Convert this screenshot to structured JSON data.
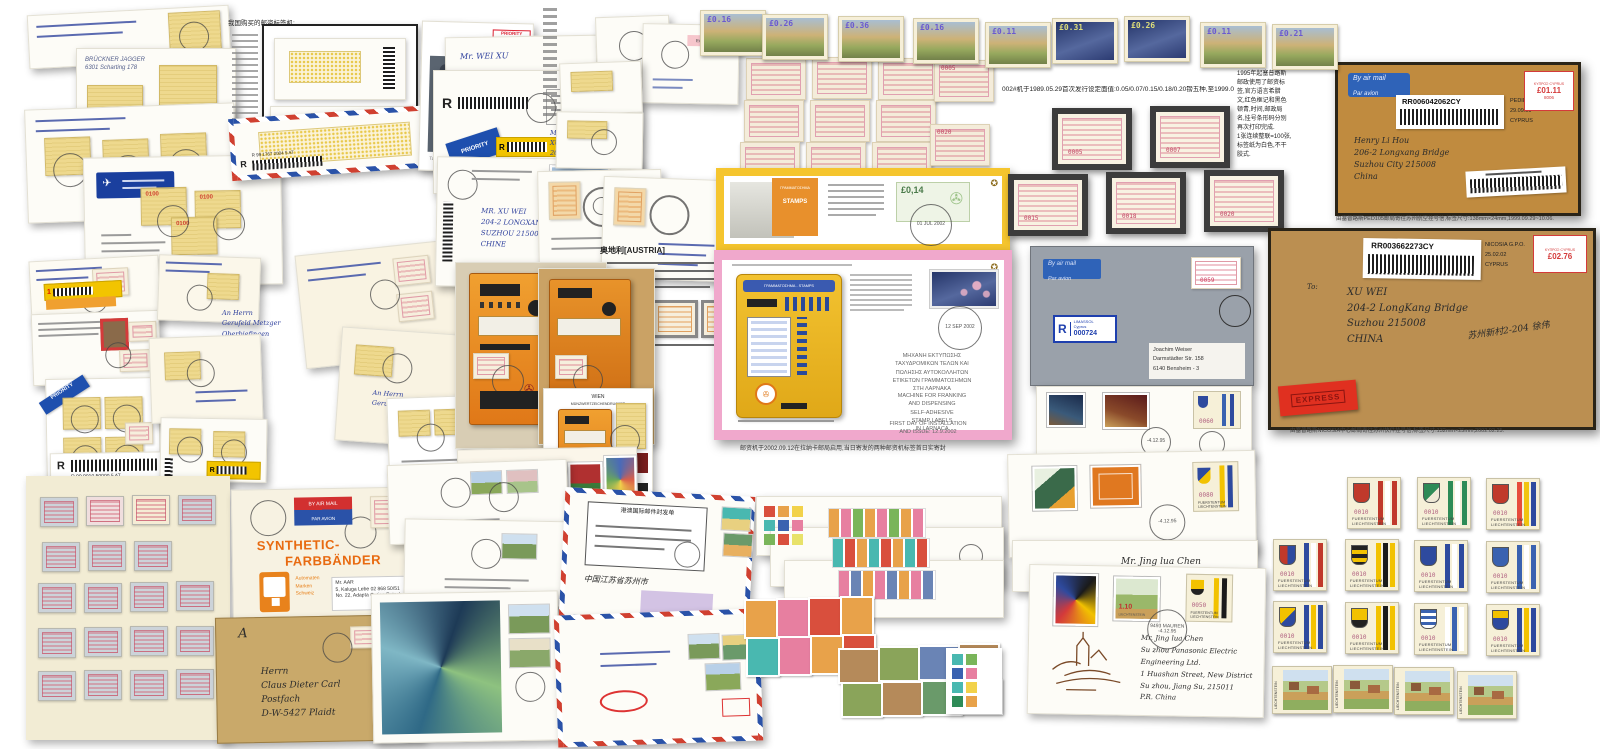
{
  "top_row": {
    "stamps": [
      {
        "x": 700,
        "y": 10,
        "v": "£0.16",
        "bg": "linear-gradient(180deg,#a9bed2 0%,#cdb277 45%,#97a95e 72%,#72814a 100%)",
        "vc": "#6a5ad0"
      },
      {
        "x": 762,
        "y": 14,
        "v": "£0.26",
        "bg": "linear-gradient(180deg,#a9bed2 0%,#cdb277 45%,#97a95e 72%,#72814a 100%)",
        "vc": "#6a5ad0"
      },
      {
        "x": 838,
        "y": 16,
        "v": "£0.36",
        "bg": "linear-gradient(180deg,#a9bed2 0%,#cdb277 45%,#97a95e 72%,#72814a 100%)",
        "vc": "#6a5ad0"
      },
      {
        "x": 913,
        "y": 18,
        "v": "£0.16",
        "bg": "linear-gradient(180deg,#a9bed2 0%,#cdb277 45%,#97a95e 72%,#72814a 100%)",
        "vc": "#6a5ad0"
      },
      {
        "x": 985,
        "y": 22,
        "v": "£0.11",
        "bg": "linear-gradient(180deg,#a9bed2 0%,#cdb277 45%,#97a95e 72%,#72814a 100%)",
        "vc": "#6a5ad0"
      },
      {
        "x": 1052,
        "y": 18,
        "v": "£0.31",
        "bg": "linear-gradient(160deg,#243468,#55689e 55%,#2c3b72)",
        "vc": "#dede7a"
      },
      {
        "x": 1124,
        "y": 16,
        "v": "£0.26",
        "bg": "linear-gradient(160deg,#243468,#55689e 55%,#2c3b72)",
        "vc": "#dede7a"
      },
      {
        "x": 1200,
        "y": 22,
        "v": "£0.11",
        "bg": "linear-gradient(180deg,#a9bed2 0%,#cdb277 45%,#97a95e 72%,#72814a 100%)",
        "vc": "#6a5ad0"
      },
      {
        "x": 1272,
        "y": 24,
        "v": "£0.21",
        "bg": "linear-gradient(180deg,#a9bed2 0%,#cdb277 45%,#97a95e 72%,#72814a 100%)",
        "vc": "#6a5ad0"
      }
    ]
  },
  "cyprus": {
    "caption": "002#机于1989.05.29首次发行设定面值:0.05/0.07/0.15/0.18/0.20镑五种,至1999.0",
    "loose": [
      {
        "x": 746,
        "y": 58,
        "v": ""
      },
      {
        "x": 812,
        "y": 57,
        "v": ""
      },
      {
        "x": 878,
        "y": 58,
        "v": ""
      },
      {
        "x": 744,
        "y": 100,
        "v": ""
      },
      {
        "x": 810,
        "y": 100,
        "v": ""
      },
      {
        "x": 876,
        "y": 100,
        "v": ""
      },
      {
        "x": 740,
        "y": 142,
        "v": ""
      },
      {
        "x": 806,
        "y": 142,
        "v": ""
      },
      {
        "x": 872,
        "y": 142,
        "v": ""
      },
      {
        "x": 934,
        "y": 60,
        "v": "0005"
      },
      {
        "x": 930,
        "y": 124,
        "v": "0020"
      }
    ],
    "framed": [
      {
        "x": 1052,
        "y": 108,
        "v": "0005"
      },
      {
        "x": 1150,
        "y": 106,
        "v": "0007"
      },
      {
        "x": 1008,
        "y": 174,
        "v": "0015"
      },
      {
        "x": 1106,
        "y": 172,
        "v": "0018"
      },
      {
        "x": 1204,
        "y": 170,
        "v": "0020"
      }
    ],
    "notes": [
      "1995年起塞普路斯",
      "邮政使用了邮资标",
      "签,官方语言希腊",
      "文,红色框记和黑色",
      "顿青,时间,邮政局",
      "名,挂号条形码分别",
      "再次打印完成.",
      "1张连续整联=100张,",
      "标签纸为白色,不干",
      "胶式."
    ]
  },
  "env1": {
    "air1": "By air mail",
    "air2": "Par avion",
    "code": "RR006042062CY",
    "po": "PEDIEOS P.O.",
    "date": "29.09.99",
    "country": "CYPRUS",
    "meter": "£01.11",
    "meter_no": "8006",
    "meter_hdr": "ΚΥΠΡΟΣ·CYPRUS",
    "addr": [
      "Henry Li Hou",
      "206-2 Longxang Bridge",
      "Suzhou City 215008",
      "China"
    ],
    "caption": "由塞普路斯PED105邮局寄往苏州航空挂号信,标签尺寸:138mm×24mm,1999.09.29~10.06."
  },
  "env2": {
    "code": "RR003662273CY",
    "po": "NICOSIA G.P.O.",
    "date": "25.02.02",
    "country": "CYPRUS",
    "meter": "£02.76",
    "meter_hdr": "ΚΥΠΡΟΣ·CYPRUS",
    "to": "To:",
    "addr": [
      "XU WEI",
      "204-2 LongKang Bridge",
      "Suzhou 215008",
      "CHINA"
    ],
    "note_cn": "苏州新村2-204 徐伟",
    "express": "EXPRESS",
    "caption": "由塞普路斯NICOSIA中心邮局寄往苏州快件挂号信,标签尺寸:132mm×25mm,2002.02.25."
  },
  "gray_cover": {
    "air1": "By air mail",
    "air2": "Par avion",
    "r": "R",
    "r_city": "LIMASSOL",
    "r_sub": "Cyprus",
    "r_no": "000724",
    "atm": "0059",
    "addr": [
      "Joachim Weiser",
      "Darmstädter Str. 158",
      "6140 Bensheim - 3"
    ]
  },
  "brochures": {
    "machine_title": "ΓΡΑΜΜΑΤΟΣΗΜΑ - STAMPS",
    "poster1": "ΓΡΑΜΜΑΤΟΣΗΜΑ",
    "poster2": "STAMPS",
    "stamp1_value": "£0,14",
    "pm1_date": "01 JUL 2002",
    "pm2_date": "12 SEP 2002",
    "greek": [
      "ΜΗΧΑΝΗ ΕΚΤΥΠΩΣΗΣ",
      "ΤΑΧΥΔΡΟΜΙΚΩΝ ΤΕΛΩΝ ΚΑΙ",
      "ΠΩΛΗΣΗΣ ΑΥΤΟΚΟΛΛΗΤΩΝ",
      "ΕΤΙΚΕΤΩΝ ΓΡΑΜΜΑΤΟΣΗΜΩΝ",
      "ΣΤΗ ΛΑΡΝΑΚΑ"
    ],
    "english": [
      "MACHINE FOR FRANKING",
      "AND DISPENSING",
      "SELF-ADHESIVE",
      "STAMP LABELS",
      "IN LARNACA"
    ],
    "first_day": [
      "FIRST DAY OF INSTALLATION",
      "AND ISSUE: 12.9.2002"
    ],
    "caption_cn": "邮资机于2002.09.12在拉纳卡邮局启用,当日寄发的两种邮资机标签首日实寄封"
  },
  "austria": {
    "heading": "奥地利[AUSTRIA]",
    "wien1": "WIEN",
    "wien2": "MÜNZWERTZEICHENDRUCKER",
    "fdc_hand": [
      "204-2 Long Kang Bridge",
      "Su Zhou 215008"
    ]
  },
  "liech": {
    "value": "0010",
    "c1": "FUERSTENTUM",
    "c2": "LIECHTENSTEIN",
    "grid": [
      {
        "x": 1347,
        "y": 477,
        "shield": "#c0392b",
        "s1": "#c0392b",
        "s2": "#ffffff",
        "s3": "#c0392b"
      },
      {
        "x": 1417,
        "y": 477,
        "shield": "linear-gradient(135deg,#2e8b57 55%,#eee8d5 55%)",
        "s1": "#2e8b57",
        "s2": "#ffffff",
        "s3": "#2e8b57"
      },
      {
        "x": 1486,
        "y": 478,
        "shield": "#c0392b",
        "s1": "#e74c3c",
        "s2": "#f1c40f",
        "s3": "#2e4a9e"
      },
      {
        "x": 1273,
        "y": 539,
        "shield": "linear-gradient(90deg,#c0392b 50%,#2e4a9e 50%)",
        "s1": "#2e4a9e",
        "s2": "#ffffff",
        "s3": "#c0392b"
      },
      {
        "x": 1345,
        "y": 539,
        "shield": "repeating-linear-gradient(180deg,#222 0 4px,#f2c200 4px 8px)",
        "s1": "#f2c200",
        "s2": "#1a1a1a",
        "s3": "#f2c200"
      },
      {
        "x": 1414,
        "y": 540,
        "shield": "#2e4a9e",
        "s1": "#2e4a9e",
        "s2": "#ffffff",
        "s3": "#2e4a9e"
      },
      {
        "x": 1486,
        "y": 541,
        "shield": "#3a62b0",
        "s1": "#3a62b0",
        "s2": "#ffffff",
        "s3": "#3a62b0"
      },
      {
        "x": 1273,
        "y": 601,
        "shield": "linear-gradient(135deg,#f2c200 50%,#2e4a9e 50%)",
        "s1": "#2e4a9e",
        "s2": "#f2c200",
        "s3": "#2e4a9e"
      },
      {
        "x": 1345,
        "y": 602,
        "shield": "linear-gradient(180deg,#f2c200 60%,#222 60%)",
        "s1": "#f2c200",
        "s2": "#1a1a1a",
        "s3": "#f2c200"
      },
      {
        "x": 1414,
        "y": 603,
        "shield": "repeating-linear-gradient(180deg,#3a62b0 0 3px,#ffffff 3px 6px)",
        "s1": "#ffffff",
        "s2": "#3a62b0",
        "s3": "#ffffff"
      },
      {
        "x": 1486,
        "y": 604,
        "shield": "linear-gradient(180deg,#f2c200 40%,#2e4a9e 40%)",
        "s1": "#2e4a9e",
        "s2": "#f2c200",
        "s3": "#2e4a9e"
      }
    ],
    "villages": [
      {
        "x": 1272,
        "y": 666
      },
      {
        "x": 1333,
        "y": 665
      },
      {
        "x": 1394,
        "y": 667
      },
      {
        "x": 1457,
        "y": 671
      }
    ],
    "atm60": "0060",
    "atm80": "0080",
    "atm50": "0050",
    "green_value": "1.10",
    "green_country": "LIECHTENSTEIN",
    "pm_town": "9493 MAUREN",
    "pm_date": "-4.12.95",
    "fdc3_name": "Mr. Jing lua Chen",
    "owl_addr": [
      "Mr. Jing lua Chen",
      "Su zhou Panasonic Electric Engineering Ltd.",
      "1 Huashan Street, New District",
      "Su zhou, Jiang Su, 215011",
      "P.R. China"
    ]
  },
  "registered": {
    "r": "R",
    "priority1": "PRIORITY",
    "priority2": "PRIORITAIRE",
    "weixu": "Mr. WEI XU",
    "d1_hand": [
      "Mr.",
      "XU WEI",
      "206-2 Longxang Brd."
    ],
    "d2_addr": [
      "MR. XU WEI",
      "204-2 LONGXANG BRIDGE",
      "SUZHOU 215008",
      "CHINE"
    ],
    "code_b": "R 99 1767 2004 5 AT",
    "code_s7": "R 99 9010 50000 5 AT"
  },
  "synthetic": {
    "airmail": "BY AIR MAIL",
    "parvion": "PAR AVION",
    "t1": "SYNTHETIC-",
    "t2": "FARBBÄNDER",
    "sub": [
      "Automaten",
      "Marken",
      "Schweiz"
    ],
    "addr": [
      "Mr. AAR",
      "5, Kaluga Lebe 02 868 50/51",
      "No. 22, Adapta Outing Patnab"
    ]
  },
  "kraft_env": {
    "a": "A",
    "addr": [
      "Herrn",
      "Claus Dieter Carl",
      "Postfach",
      "D-W-5427 Plaidt"
    ]
  },
  "misc": {
    "cn_heading": "我国购买的邮资标签机:",
    "postbus": "Tag der Briefmarke",
    "eulach": "Eulach - Natur",
    "brueckner": [
      "BRÜCKNER JAGGER",
      "6301 Scharting 178"
    ],
    "atm_0100": "0100",
    "cn_form": "港澳国际邮件封发单",
    "cn_hand": "中国江苏省苏州市",
    "m2_hand": [
      "An Herrn",
      "Gerufeld Metzger"
    ]
  },
  "album": {
    "stamps": [
      {
        "x": 40,
        "y": 497,
        "bg": "#ccd3d9"
      },
      {
        "x": 86,
        "y": 496,
        "bg": "#f0dede"
      },
      {
        "x": 132,
        "y": 495,
        "bg": "#f5ecd5"
      },
      {
        "x": 178,
        "y": 495,
        "bg": "#ccd3d9"
      },
      {
        "x": 42,
        "y": 542,
        "bg": "#ccd3d9"
      },
      {
        "x": 88,
        "y": 541,
        "bg": "#ccd3d9"
      },
      {
        "x": 134,
        "y": 541,
        "bg": "#ccd3d9"
      },
      {
        "x": 38,
        "y": 583,
        "bg": "#ccd3d9"
      },
      {
        "x": 84,
        "y": 583,
        "bg": "#ccd3d9"
      },
      {
        "x": 130,
        "y": 582,
        "bg": "#ccd3d9"
      },
      {
        "x": 176,
        "y": 581,
        "bg": "#ccd3d9"
      },
      {
        "x": 38,
        "y": 628,
        "bg": "#ccd3d9"
      },
      {
        "x": 84,
        "y": 627,
        "bg": "#ccd3d9"
      },
      {
        "x": 130,
        "y": 626,
        "bg": "#ccd3d9"
      },
      {
        "x": 176,
        "y": 626,
        "bg": "#ccd3d9"
      },
      {
        "x": 38,
        "y": 671,
        "bg": "#ccd3d9"
      },
      {
        "x": 84,
        "y": 670,
        "bg": "#ccd3d9"
      },
      {
        "x": 130,
        "y": 670,
        "bg": "#ccd3d9"
      },
      {
        "x": 176,
        "y": 669,
        "bg": "#ccd3d9"
      }
    ]
  },
  "grids": {
    "g1": [
      {
        "x": 744,
        "y": 599,
        "bg": "#e8a24a"
      },
      {
        "x": 776,
        "y": 598,
        "bg": "#e77fa0"
      },
      {
        "x": 808,
        "y": 597,
        "bg": "#d94f3d"
      },
      {
        "x": 840,
        "y": 596,
        "bg": "#e8a24a"
      },
      {
        "x": 746,
        "y": 637,
        "bg": "#49b8b0"
      },
      {
        "x": 778,
        "y": 636,
        "bg": "#e77fa0"
      },
      {
        "x": 810,
        "y": 635,
        "bg": "#e8a24a"
      },
      {
        "x": 842,
        "y": 634,
        "bg": "#d94f3d"
      }
    ],
    "g2": [
      {
        "x": 838,
        "y": 648,
        "bg": "#b58a5a"
      },
      {
        "x": 878,
        "y": 646,
        "bg": "#8aa45a"
      },
      {
        "x": 918,
        "y": 645,
        "bg": "#6a84b5"
      },
      {
        "x": 958,
        "y": 643,
        "bg": "#b58a5a"
      },
      {
        "x": 841,
        "y": 682,
        "bg": "#8aa45a"
      },
      {
        "x": 881,
        "y": 681,
        "bg": "#b58a5a"
      },
      {
        "x": 921,
        "y": 680,
        "bg": "#6a9a6a"
      },
      {
        "x": 961,
        "y": 679,
        "bg": "#a5865a"
      }
    ],
    "sw1": [
      {
        "x": 764,
        "y": 506,
        "bg": "#d94f3d"
      },
      {
        "x": 778,
        "y": 506,
        "bg": "#e8a24a"
      },
      {
        "x": 792,
        "y": 506,
        "bg": "#f2d24a"
      },
      {
        "x": 764,
        "y": 520,
        "bg": "#49b8b0"
      },
      {
        "x": 778,
        "y": 520,
        "bg": "#3a62b0"
      },
      {
        "x": 792,
        "y": 520,
        "bg": "#e77fa0"
      },
      {
        "x": 764,
        "y": 534,
        "bg": "#7ab55a"
      },
      {
        "x": 778,
        "y": 534,
        "bg": "#d94f3d"
      },
      {
        "x": 792,
        "y": 534,
        "bg": "#e8e26a"
      }
    ],
    "sw2": [
      {
        "x": 952,
        "y": 654,
        "bg": "#49b8b0"
      },
      {
        "x": 966,
        "y": 654,
        "bg": "#7ab55a"
      },
      {
        "x": 952,
        "y": 668,
        "bg": "#3a62b0"
      },
      {
        "x": 966,
        "y": 668,
        "bg": "#e77fa0"
      },
      {
        "x": 952,
        "y": 682,
        "bg": "#49b8b0"
      },
      {
        "x": 966,
        "y": 682,
        "bg": "#f2d24a"
      },
      {
        "x": 952,
        "y": 696,
        "bg": "#2e8b57"
      },
      {
        "x": 966,
        "y": 696,
        "bg": "#e8a24a"
      }
    ]
  }
}
